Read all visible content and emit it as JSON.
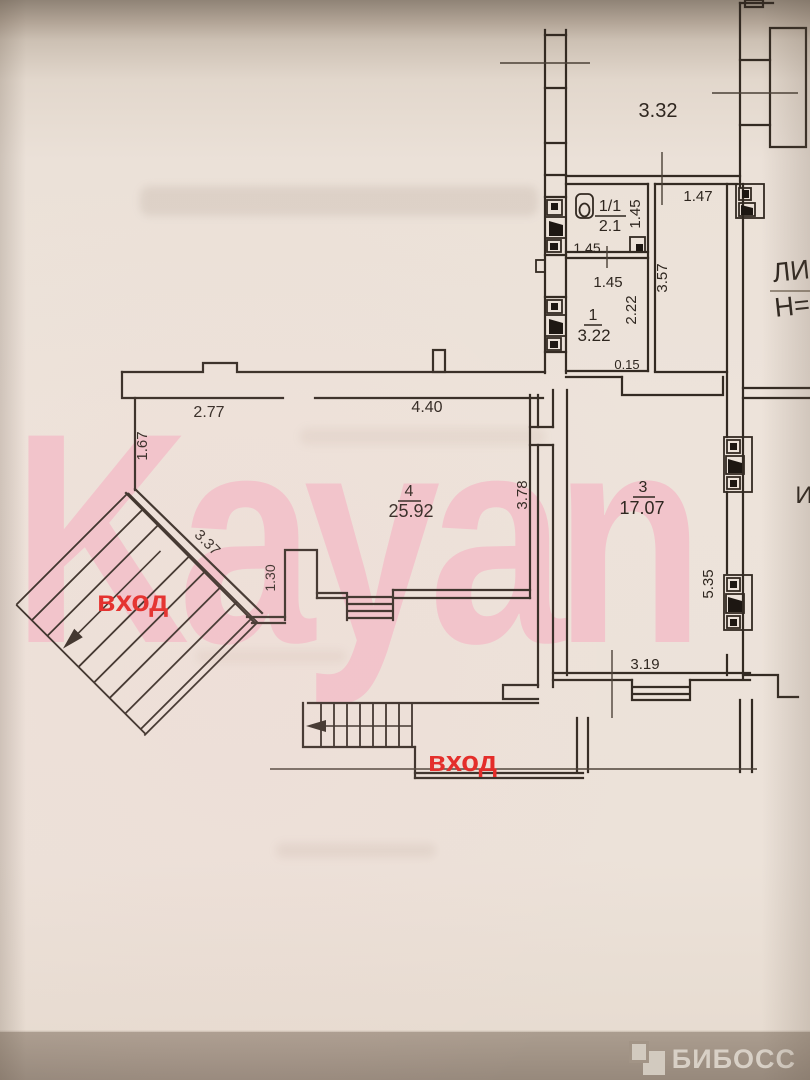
{
  "floor_plan": {
    "watermark_text": "Kayan",
    "brand_logo": "БИБОСС",
    "entrance_label_left": "вход",
    "entrance_label_bottom": "вход",
    "handwritten_notes": {
      "note_line1": "ЛИ",
      "note_line2": "Н=",
      "note_side": "И"
    },
    "rooms": [
      {
        "number": "1/1",
        "area": "2.1"
      },
      {
        "number": "1",
        "area": "3.22"
      },
      {
        "number": "3",
        "area": "17.07"
      },
      {
        "number": "4",
        "area": "25.92"
      }
    ],
    "dimensions": {
      "top_hall_width": "3.32",
      "right_strip_width": "1.47",
      "wc_right": "1.45",
      "wc_bottom": "1.45",
      "room1_top": "1.45",
      "strip_height": "3.57",
      "room1_right": "2.22",
      "small_offset": "0.15",
      "room4_top_left": "2.77",
      "room4_top_right": "4.40",
      "room4_left": "1.67",
      "room4_right": "3.78",
      "diagonal_wall": "3.37",
      "pier_height": "1.30",
      "room3_right": "5.35",
      "room3_bottom": "3.19"
    },
    "colors": {
      "ink": "#332a22",
      "red_label": "#e3231f",
      "watermark_pink": "#f3bfc9",
      "paper": "#ece2d9",
      "pencil_gray": "#8e8172",
      "footer_bar": "#a2948 6"
    }
  }
}
